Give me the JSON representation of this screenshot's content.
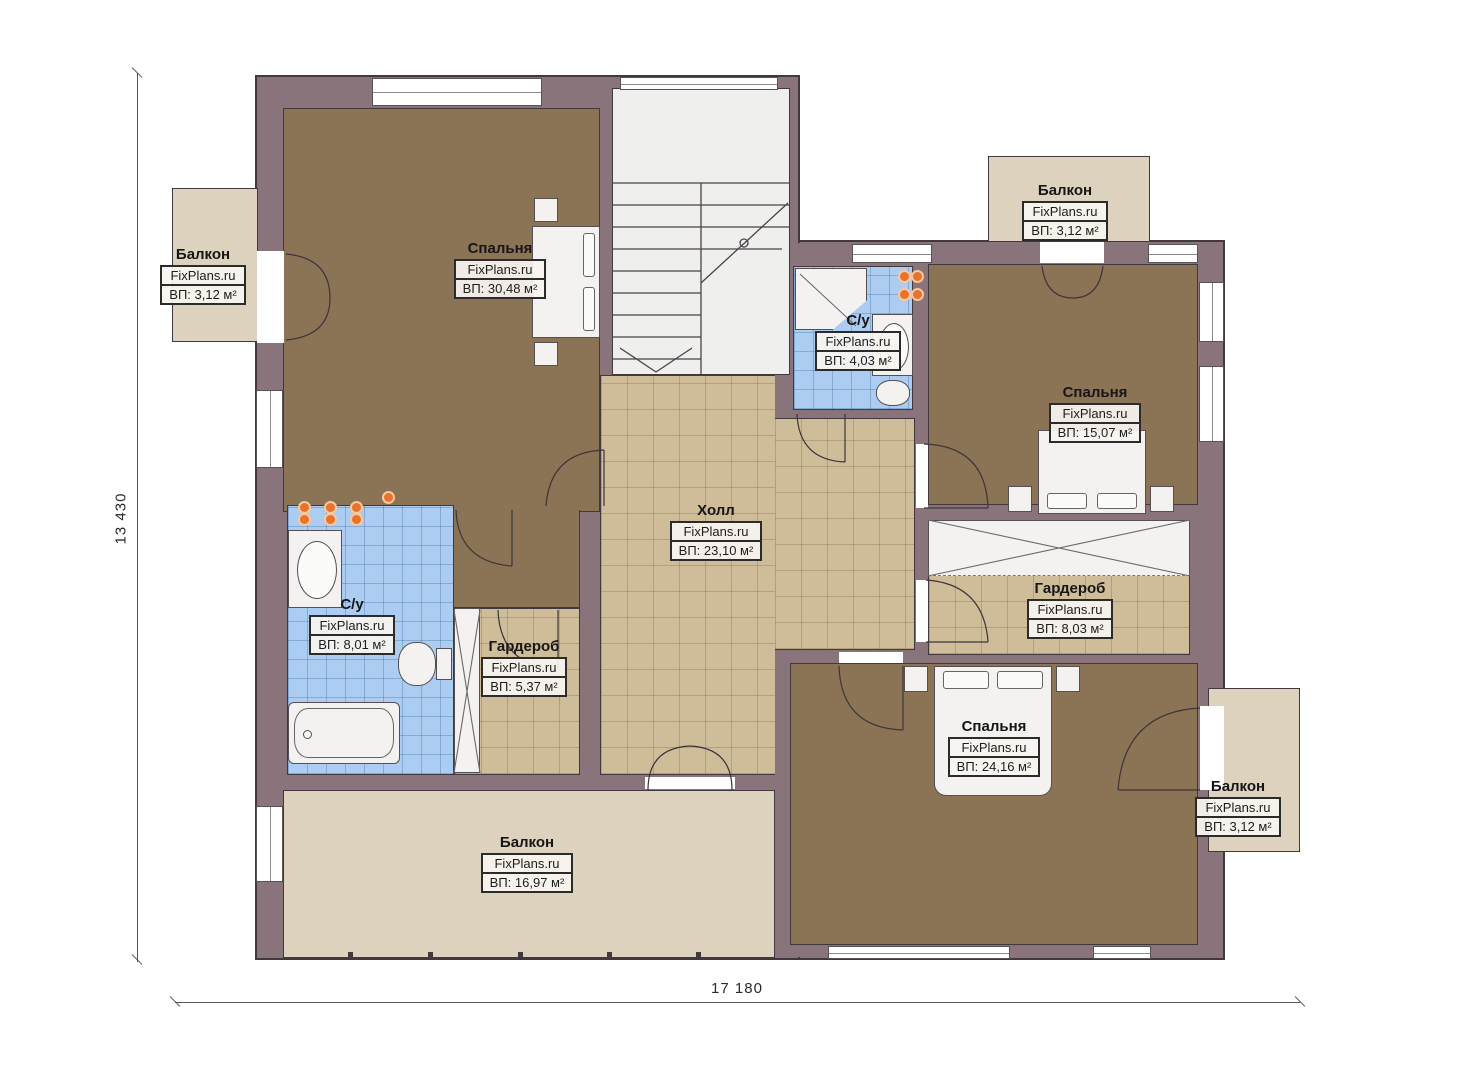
{
  "dimensions": {
    "height_label": "13 430",
    "width_label": "17 180"
  },
  "watermark": "FixPlans.ru",
  "rooms": [
    {
      "id": "bedroom-top-left",
      "name": "Спальня",
      "watermark": "FixPlans.ru",
      "area": "ВП: 30,48 м²"
    },
    {
      "id": "balcony-left",
      "name": "Балкон",
      "watermark": "FixPlans.ru",
      "area": "ВП: 3,12 м²"
    },
    {
      "id": "balcony-top-right",
      "name": "Балкон",
      "watermark": "FixPlans.ru",
      "area": "ВП: 3,12 м²"
    },
    {
      "id": "bathroom-top",
      "name": "С/у",
      "watermark": "FixPlans.ru",
      "area": "ВП: 4,03 м²"
    },
    {
      "id": "bedroom-right",
      "name": "Спальня",
      "watermark": "FixPlans.ru",
      "area": "ВП: 15,07 м²"
    },
    {
      "id": "hall",
      "name": "Холл",
      "watermark": "FixPlans.ru",
      "area": "ВП: 23,10 м²"
    },
    {
      "id": "wardrobe-right",
      "name": "Гардероб",
      "watermark": "FixPlans.ru",
      "area": "ВП: 8,03 м²"
    },
    {
      "id": "bathroom-left",
      "name": "С/у",
      "watermark": "FixPlans.ru",
      "area": "ВП: 8,01 м²"
    },
    {
      "id": "wardrobe-small",
      "name": "Гардероб",
      "watermark": "FixPlans.ru",
      "area": "ВП: 5,37 м²"
    },
    {
      "id": "bedroom-bottom",
      "name": "Спальня",
      "watermark": "FixPlans.ru",
      "area": "ВП: 24,16 м²"
    },
    {
      "id": "balcony-bottom",
      "name": "Балкон",
      "watermark": "FixPlans.ru",
      "area": "ВП: 16,97 м²"
    },
    {
      "id": "balcony-bottom-right",
      "name": "Балкон",
      "watermark": "FixPlans.ru",
      "area": "ВП: 3,12 м²"
    }
  ],
  "colors": {
    "wall": "#8a747b",
    "floor_wood": "#8b7456",
    "tile_tan": "#cfbc99",
    "tile_blue": "#accdf1",
    "balcony": "#ddd2bd",
    "stairs": "#efefee",
    "accent_orange": "#e8732e"
  }
}
